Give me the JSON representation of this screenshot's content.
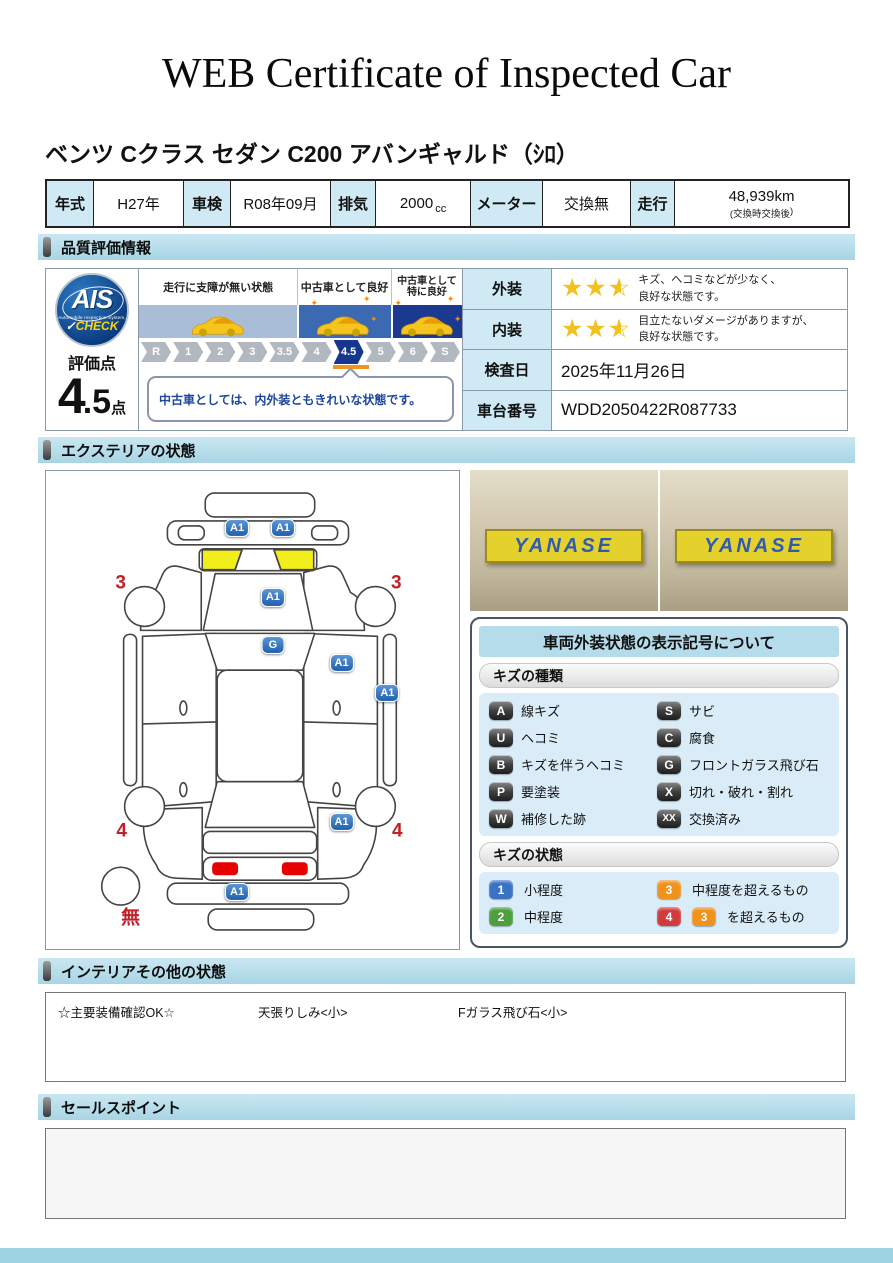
{
  "title": "WEB Certificate of Inspected Car",
  "car_name": "ベンツ Cクラス セダン C200 アバンギャルド（ｼﾛ）",
  "colors": {
    "section_header": "#aed9e6",
    "table_label_bg": "#cfeaf4",
    "star": "#f2c11e",
    "marker_blue": "#2060ae",
    "zone_colors": [
      "#a9bdd7",
      "#3c6ab2",
      "#1b3a8f"
    ],
    "active_step": "#17378e"
  },
  "spec": {
    "year_label": "年式",
    "year_value": "H27年",
    "inspection_label": "車検",
    "inspection_value": "R08年09月",
    "displacement_label": "排気",
    "displacement_value": "2000",
    "displacement_unit": "cc",
    "meter_label": "メーター",
    "meter_value": "交換無",
    "mileage_label": "走行",
    "mileage_value": "48,939km",
    "mileage_note_open": "(交換時",
    "mileage_note_mid": "交換後",
    "mileage_note_close": ")"
  },
  "sections": {
    "quality": "品質評価情報",
    "exterior": "エクステリアの状態",
    "interior": "インテリアその他の状態",
    "sales": "セールスポイント"
  },
  "quality": {
    "ais": {
      "logo_main": "AIS",
      "logo_sub": "Automobile Inspection System,",
      "logo_check_mark": "✓",
      "logo_check": "CHECK",
      "score_label": "評価点",
      "score_main": "4",
      "score_fraction": ".5",
      "score_unit": "点"
    },
    "scale": {
      "zones": [
        {
          "label": "走行に支障が無い状態"
        },
        {
          "label": "中古車として良好"
        },
        {
          "label": "中古車として特に良好"
        }
      ],
      "steps": [
        "R",
        "1",
        "2",
        "3",
        "3.5",
        "4",
        "4.5",
        "5",
        "6",
        "S"
      ],
      "active": "4.5",
      "comment": "中古車としては、内外装ともきれいな状態です。"
    },
    "rows": [
      {
        "label": "外装",
        "stars": 2.5,
        "line1": "キズ、ヘコミなどが少なく、",
        "line2": "良好な状態です。"
      },
      {
        "label": "内装",
        "stars": 2.5,
        "line1": "目立たないダメージがありますが、",
        "line2": "良好な状態です。"
      },
      {
        "label": "検査日",
        "value": "2025年11月26日"
      },
      {
        "label": "車台番号",
        "value": "WDD2050422R087733"
      }
    ]
  },
  "exterior": {
    "photos": [
      "YANASE",
      "YANASE"
    ],
    "diagram": {
      "badges": [
        {
          "label": "A1",
          "x": 192,
          "y": 57
        },
        {
          "label": "A1",
          "x": 238,
          "y": 57
        },
        {
          "label": "A1",
          "x": 228,
          "y": 127
        },
        {
          "label": "G",
          "x": 228,
          "y": 175
        },
        {
          "label": "A1",
          "x": 297,
          "y": 193
        },
        {
          "label": "A1",
          "x": 343,
          "y": 223
        },
        {
          "label": "A1",
          "x": 297,
          "y": 352
        },
        {
          "label": "A1",
          "x": 192,
          "y": 423
        }
      ],
      "numbers": [
        {
          "label": "3",
          "x": 75,
          "y": 112
        },
        {
          "label": "3",
          "x": 352,
          "y": 112
        },
        {
          "label": "4",
          "x": 76,
          "y": 362
        },
        {
          "label": "4",
          "x": 353,
          "y": 362
        },
        {
          "label": "無",
          "x": 85,
          "y": 449
        }
      ]
    },
    "legend": {
      "title": "車両外装状態の表示記号について",
      "kind_header": "キズの種類",
      "kinds": [
        {
          "code": "A",
          "label": "線キズ"
        },
        {
          "code": "S",
          "label": "サビ"
        },
        {
          "code": "U",
          "label": "ヘコミ"
        },
        {
          "code": "C",
          "label": "腐食"
        },
        {
          "code": "B",
          "label": "キズを伴うヘコミ"
        },
        {
          "code": "G",
          "label": "フロントガラス飛び石"
        },
        {
          "code": "P",
          "label": "要塗装"
        },
        {
          "code": "X",
          "label": "切れ・破れ・割れ"
        },
        {
          "code": "W",
          "label": "補修した跡"
        },
        {
          "code": "XX",
          "label": "交換済み"
        }
      ],
      "state_header": "キズの状態",
      "states": [
        {
          "badges": [
            {
              "code": "1",
              "color": "#3b72c4"
            }
          ],
          "label": "小程度"
        },
        {
          "badges": [
            {
              "code": "3",
              "color": "#f0921e"
            }
          ],
          "label": "中程度を超えるもの"
        },
        {
          "badges": [
            {
              "code": "2",
              "color": "#4e9e3d"
            }
          ],
          "label": "中程度"
        },
        {
          "badges": [
            {
              "code": "4",
              "color": "#d23b3e"
            },
            {
              "code": "3",
              "color": "#f0921e"
            }
          ],
          "label": "を超えるもの"
        }
      ]
    }
  },
  "interior": {
    "items": [
      "☆主要装備確認OK☆",
      "天張りしみ<小>",
      "Fガラス飛び石<小>"
    ]
  },
  "sales": {
    "content": ""
  }
}
